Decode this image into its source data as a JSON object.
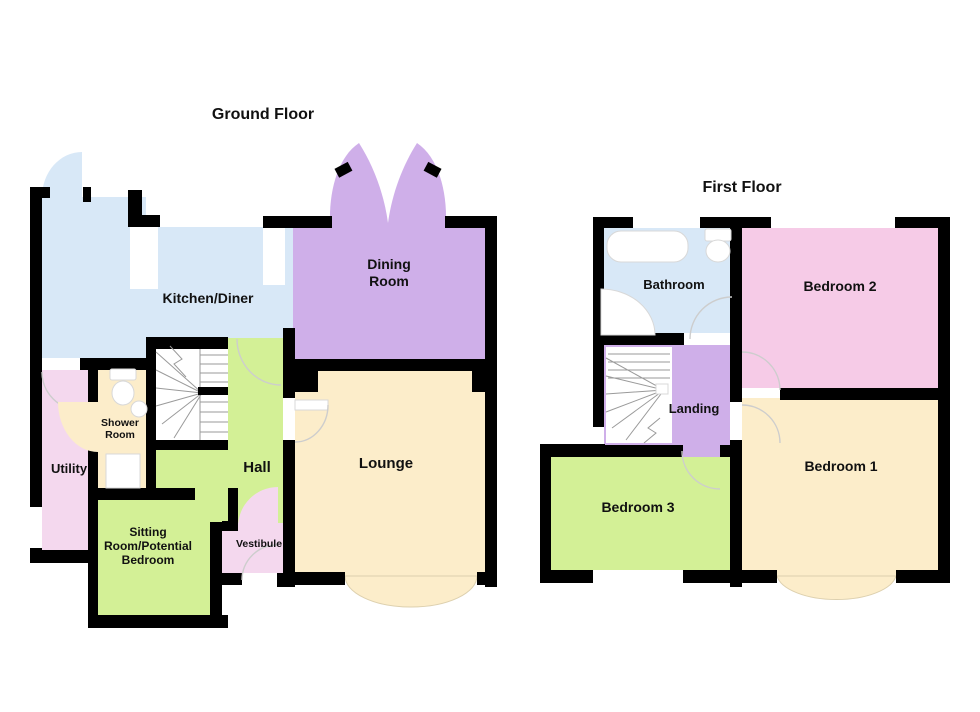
{
  "ground": {
    "title": "Ground Floor",
    "rooms": {
      "kitchen": "Kitchen/Diner",
      "dining_line1": "Dining",
      "dining_line2": "Room",
      "lounge": "Lounge",
      "hall": "Hall",
      "shower_line1": "Shower",
      "shower_line2": "Room",
      "utility": "Utility",
      "sitting_line1": "Sitting",
      "sitting_line2": "Room/Potential",
      "sitting_line3": "Bedroom",
      "vestibule": "Vestibule"
    }
  },
  "first": {
    "title": "First Floor",
    "rooms": {
      "bathroom": "Bathroom",
      "bedroom2": "Bedroom 2",
      "landing": "Landing",
      "bedroom1": "Bedroom 1",
      "bedroom3": "Bedroom 3"
    }
  },
  "colors": {
    "kitchen_blue": "#d8e8f7",
    "dining_purple": "#cfafe9",
    "cream": "#fcedca",
    "green": "#d3f096",
    "pink_light": "#f4d8ee",
    "pink_bedroom2": "#f6cbe7",
    "wall_black": "#000000",
    "door_arc_gray": "#cdcdcd",
    "stair_line_gray": "#9a9a9a",
    "text_black": "#111111"
  }
}
